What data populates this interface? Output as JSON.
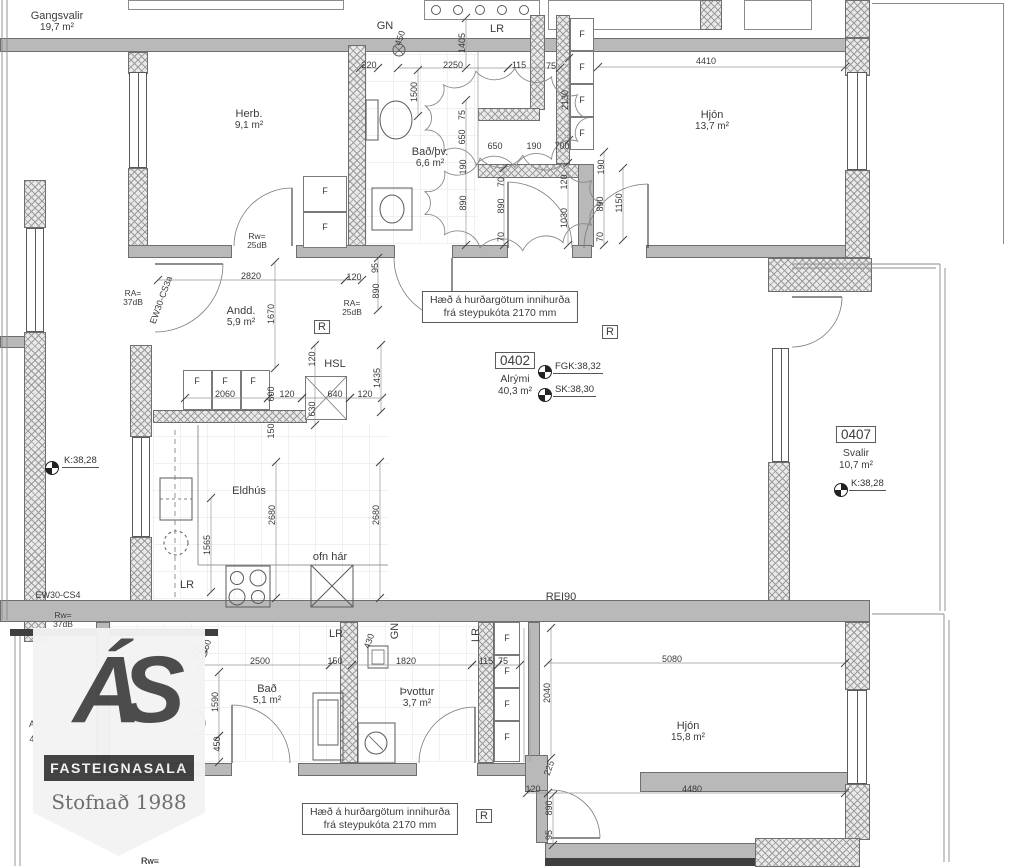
{
  "logo": {
    "monogram": "ÁS",
    "band": "FASTEIGNASALA",
    "founded": "Stofnað 1988"
  },
  "notes": {
    "door_note_line1": "Hæð á hurðargötum innihurða",
    "door_note_line2": "frá steypukóta 2170 mm",
    "rei": "REI90",
    "r_marker": "R",
    "wardrobe": "F"
  },
  "rooms": [
    {
      "label": "Gangsvalir",
      "area": "19,7 m²",
      "x": 57,
      "y": 22
    },
    {
      "label": "Herb.",
      "area": "9,1 m²",
      "x": 249,
      "y": 120
    },
    {
      "label": "Bað/þv.",
      "area": "6,6 m²",
      "x": 430,
      "y": 158
    },
    {
      "label": "Hjón",
      "area": "13,7 m²",
      "x": 712,
      "y": 121
    },
    {
      "label": "Andd.",
      "area": "5,9 m²",
      "x": 241,
      "y": 317
    },
    {
      "label": "Eldhús",
      "area": "",
      "x": 249,
      "y": 491
    },
    {
      "label": "Bað",
      "area": "5,1 m²",
      "x": 267,
      "y": 695
    },
    {
      "label": "Þvottur",
      "area": "3,7 m²",
      "x": 417,
      "y": 698
    },
    {
      "label": "Hjón",
      "area": "15,8 m²",
      "x": 688,
      "y": 732
    }
  ],
  "units": [
    {
      "number": "0402",
      "name": "Alrými",
      "area": "40,3 m²",
      "x": 515,
      "y": 352
    },
    {
      "number": "0407",
      "name": "Svalir",
      "area": "10,7 m²",
      "x": 856,
      "y": 426
    }
  ],
  "levels": [
    {
      "label": "FGK:38,32",
      "x": 553,
      "y": 361,
      "sx": 545,
      "sy": 372
    },
    {
      "label": "SK:38,30",
      "x": 553,
      "y": 384,
      "sx": 545,
      "sy": 395
    },
    {
      "label": "K:38,28",
      "x": 62,
      "y": 455,
      "sx": 52,
      "sy": 468
    },
    {
      "label": "K:38,28",
      "x": 849,
      "y": 478,
      "sx": 841,
      "sy": 490
    }
  ],
  "acoustic": [
    {
      "l1": "Rw=",
      "l2": "25dB",
      "x": 257,
      "y": 241
    },
    {
      "l1": "RA=",
      "l2": "37dB",
      "x": 133,
      "y": 298
    },
    {
      "l1": "RA=",
      "l2": "25dB",
      "x": 352,
      "y": 308
    },
    {
      "l1": "Rw=",
      "l2": "37dB",
      "x": 63,
      "y": 620
    },
    {
      "l1": "Rw=",
      "l2": "",
      "x": 150,
      "y": 861
    }
  ],
  "wall_labels": [
    {
      "t": "EW30-CS3a",
      "x": 161,
      "y": 300,
      "r": -70
    },
    {
      "t": "EW30-CS4",
      "x": 58,
      "y": 595,
      "r": 0
    }
  ],
  "misc_labels": [
    {
      "t": "GN",
      "x": 385,
      "y": 26,
      "r": 0
    },
    {
      "t": "LR",
      "x": 497,
      "y": 29,
      "r": 0
    },
    {
      "t": "HSL",
      "x": 335,
      "y": 364,
      "r": 0
    },
    {
      "t": "LR",
      "x": 187,
      "y": 585,
      "r": 0
    },
    {
      "t": "ofn hár",
      "x": 330,
      "y": 557,
      "r": 0
    },
    {
      "t": "REI90",
      "x": 561,
      "y": 597,
      "r": 0
    },
    {
      "t": "LR",
      "x": 336,
      "y": 634,
      "r": 0
    },
    {
      "t": "GN",
      "x": 395,
      "y": 631,
      "r": -90
    },
    {
      "t": "LR",
      "x": 476,
      "y": 635,
      "r": -90
    }
  ],
  "fragments": [
    {
      "t": "A",
      "x": 32,
      "y": 724
    },
    {
      "t": "4",
      "x": 32,
      "y": 739
    },
    {
      "t": "Rw=",
      "x": 150,
      "y": 861
    }
  ],
  "dims": [
    {
      "t": "220",
      "x": 369,
      "y": 65,
      "r": 0
    },
    {
      "t": "2250",
      "x": 453,
      "y": 65,
      "r": 0
    },
    {
      "t": "115",
      "x": 519,
      "y": 65,
      "r": 0
    },
    {
      "t": "75",
      "x": 551,
      "y": 66,
      "r": 0
    },
    {
      "t": "4410",
      "x": 706,
      "y": 61,
      "r": 0
    },
    {
      "t": "1405",
      "x": 462,
      "y": 43,
      "r": -90
    },
    {
      "t": "450",
      "x": 400,
      "y": 38,
      "r": -70
    },
    {
      "t": "1500",
      "x": 414,
      "y": 92,
      "r": -90
    },
    {
      "t": "75",
      "x": 462,
      "y": 115,
      "r": -90
    },
    {
      "t": "650",
      "x": 462,
      "y": 137,
      "r": -90
    },
    {
      "t": "190",
      "x": 463,
      "y": 167,
      "r": -90
    },
    {
      "t": "890",
      "x": 463,
      "y": 203,
      "r": -90
    },
    {
      "t": "70",
      "x": 501,
      "y": 182,
      "r": -90
    },
    {
      "t": "890",
      "x": 501,
      "y": 206,
      "r": -90
    },
    {
      "t": "70",
      "x": 501,
      "y": 237,
      "r": -90
    },
    {
      "t": "650",
      "x": 495,
      "y": 146,
      "r": 0
    },
    {
      "t": "190",
      "x": 534,
      "y": 146,
      "r": 0
    },
    {
      "t": "700",
      "x": 562,
      "y": 146,
      "r": 0
    },
    {
      "t": "120",
      "x": 564,
      "y": 182,
      "r": -90
    },
    {
      "t": "1030",
      "x": 564,
      "y": 218,
      "r": -90
    },
    {
      "t": "190",
      "x": 601,
      "y": 167,
      "r": -90
    },
    {
      "t": "890",
      "x": 600,
      "y": 204,
      "r": -90
    },
    {
      "t": "70",
      "x": 600,
      "y": 237,
      "r": -90
    },
    {
      "t": "1150",
      "x": 619,
      "y": 203,
      "r": -90
    },
    {
      "t": "2130",
      "x": 565,
      "y": 100,
      "r": -90
    },
    {
      "t": "2820",
      "x": 251,
      "y": 276,
      "r": 0
    },
    {
      "t": "120",
      "x": 354,
      "y": 277,
      "r": 0
    },
    {
      "t": "95",
      "x": 375,
      "y": 268,
      "r": -90
    },
    {
      "t": "890",
      "x": 376,
      "y": 291,
      "r": -90
    },
    {
      "t": "1670",
      "x": 271,
      "y": 314,
      "r": -90
    },
    {
      "t": "120",
      "x": 312,
      "y": 359,
      "r": -90
    },
    {
      "t": "2060",
      "x": 225,
      "y": 394,
      "r": 0
    },
    {
      "t": "600",
      "x": 271,
      "y": 394,
      "r": -90
    },
    {
      "t": "120",
      "x": 287,
      "y": 394,
      "r": 0
    },
    {
      "t": "640",
      "x": 335,
      "y": 394,
      "r": 0
    },
    {
      "t": "120",
      "x": 365,
      "y": 394,
      "r": 0
    },
    {
      "t": "630",
      "x": 312,
      "y": 409,
      "r": -90
    },
    {
      "t": "1435",
      "x": 377,
      "y": 378,
      "r": -90
    },
    {
      "t": "150",
      "x": 271,
      "y": 431,
      "r": -90
    },
    {
      "t": "1565",
      "x": 207,
      "y": 545,
      "r": -90
    },
    {
      "t": "2680",
      "x": 272,
      "y": 515,
      "r": -90
    },
    {
      "t": "2680",
      "x": 376,
      "y": 515,
      "r": -90
    },
    {
      "t": "2500",
      "x": 260,
      "y": 661,
      "r": 0
    },
    {
      "t": "150",
      "x": 335,
      "y": 661,
      "r": 0
    },
    {
      "t": "1820",
      "x": 406,
      "y": 661,
      "r": 0
    },
    {
      "t": "115",
      "x": 486,
      "y": 661,
      "r": 0
    },
    {
      "t": "75",
      "x": 503,
      "y": 661,
      "r": 0
    },
    {
      "t": "430",
      "x": 369,
      "y": 641,
      "r": -70
    },
    {
      "t": "1590",
      "x": 215,
      "y": 702,
      "r": -90
    },
    {
      "t": "450",
      "x": 217,
      "y": 744,
      "r": -90
    },
    {
      "t": "450",
      "x": 206,
      "y": 647,
      "r": -70
    },
    {
      "t": "5080",
      "x": 672,
      "y": 659,
      "r": 0
    },
    {
      "t": "2040",
      "x": 547,
      "y": 693,
      "r": -90
    },
    {
      "t": "225",
      "x": 549,
      "y": 768,
      "r": -70
    },
    {
      "t": "120",
      "x": 533,
      "y": 789,
      "r": 0
    },
    {
      "t": "4480",
      "x": 692,
      "y": 789,
      "r": 0
    },
    {
      "t": "890",
      "x": 549,
      "y": 808,
      "r": -90
    },
    {
      "t": "95",
      "x": 549,
      "y": 835,
      "r": -90
    }
  ],
  "f_positions": [
    {
      "x": 325,
      "y": 191
    },
    {
      "x": 325,
      "y": 227
    },
    {
      "x": 582,
      "y": 34
    },
    {
      "x": 582,
      "y": 67
    },
    {
      "x": 582,
      "y": 100
    },
    {
      "x": 582,
      "y": 133
    },
    {
      "x": 197,
      "y": 381
    },
    {
      "x": 225,
      "y": 381
    },
    {
      "x": 253,
      "y": 381
    },
    {
      "x": 507,
      "y": 638
    },
    {
      "x": 507,
      "y": 671
    },
    {
      "x": 507,
      "y": 704
    },
    {
      "x": 507,
      "y": 737
    }
  ],
  "r_markers": [
    {
      "x": 322,
      "y": 327
    },
    {
      "x": 610,
      "y": 332
    },
    {
      "x": 484,
      "y": 816
    }
  ]
}
